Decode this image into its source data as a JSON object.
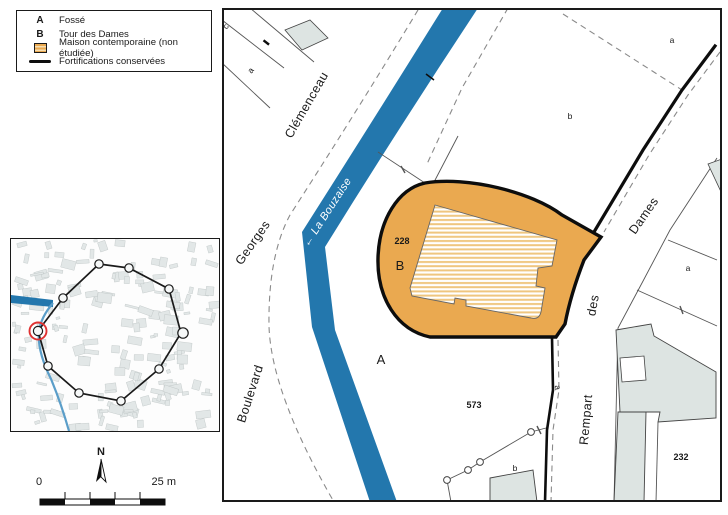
{
  "legend": {
    "items": [
      {
        "symbol": "A",
        "label": "Fossé"
      },
      {
        "symbol": "B",
        "label": "Tour des Dames"
      },
      {
        "symbol": "orange-hatched-swatch",
        "label": "Maison contemporaine (non étudiée)"
      },
      {
        "symbol": "black-line-swatch",
        "label": "Fortifications conservées"
      }
    ]
  },
  "north_arrow": {
    "label": "N"
  },
  "scale_bar": {
    "start": "0",
    "end": "25 m"
  },
  "map": {
    "streets": {
      "boulevard": "Boulevard",
      "georges": "Georges",
      "clemenceau": "Clémenceau",
      "rempart": "Rempart",
      "des": "des",
      "dames": "Dames"
    },
    "river": {
      "label": "← La Bouzaise"
    },
    "zones": {
      "fosse": "A",
      "tour": "B"
    },
    "parcel_numbers": {
      "n228": "228",
      "n573": "573",
      "n232": "232"
    },
    "letters": {
      "a": "a",
      "b": "b",
      "c": "c"
    }
  },
  "colors": {
    "river": "#2377ad",
    "tower": "#eaa950",
    "hatch_stripe": "#efc67f",
    "building": "#dde4e2",
    "fortification": "#0d0d0d",
    "highlight": "#e03232",
    "dashed": "#8a8a8a"
  }
}
